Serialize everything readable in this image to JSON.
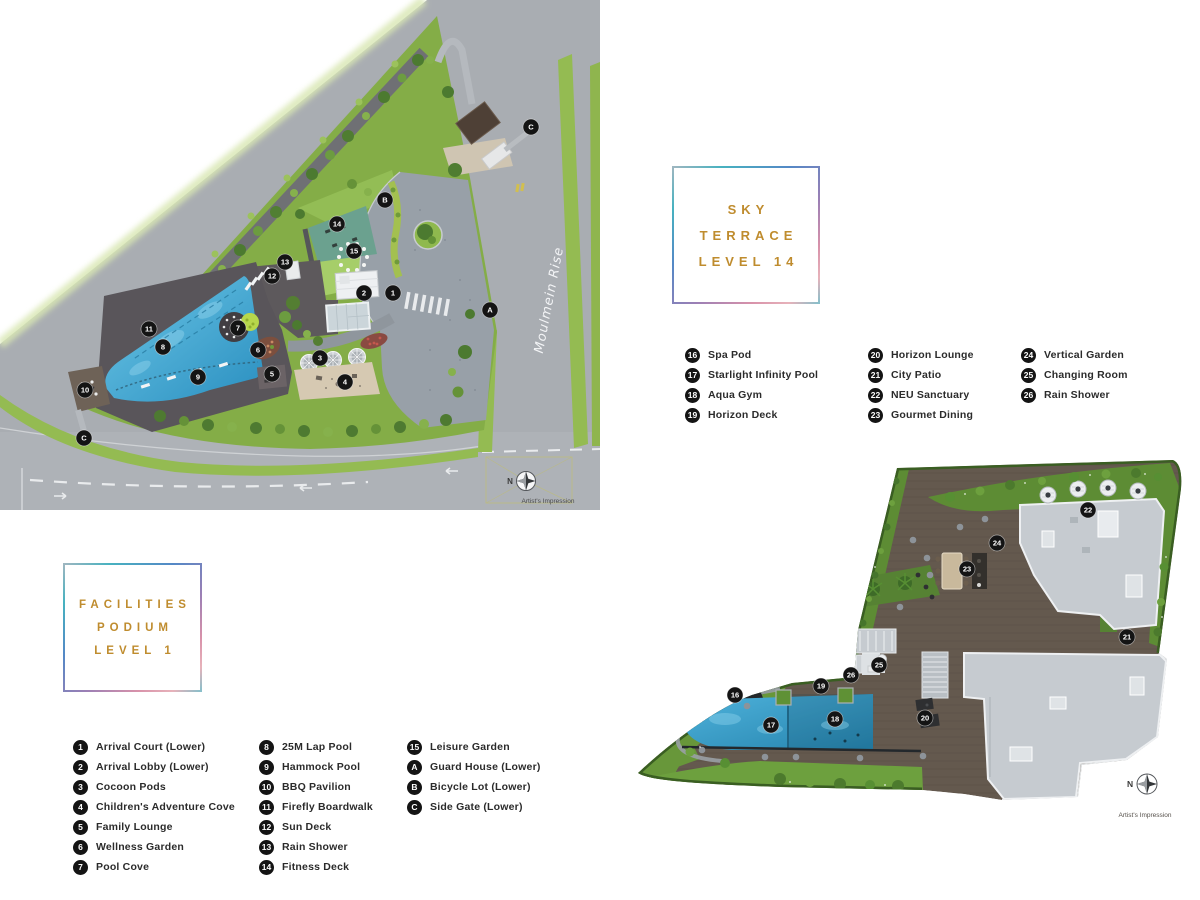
{
  "colors": {
    "accent_gold": "#bf8c2e",
    "legend_badge": "#141414",
    "legend_text": "#2b2b2b",
    "pool_blue": "#2f95c4",
    "grass_green": "#94bb52",
    "road_gray": "#a9adb2",
    "deck_wood": "#64594e",
    "roof_gray": "#c6cbd0"
  },
  "plans": {
    "podium": {
      "title_lines": [
        "FACILITIES",
        "PODIUM",
        "LEVEL 1"
      ],
      "road_label": "Moulmein Rise",
      "compass_label": "N",
      "artist_note": "Artist's Impression",
      "legend": {
        "columns": [
          [
            {
              "num": "1",
              "label": "Arrival Court (Lower)"
            },
            {
              "num": "2",
              "label": "Arrival Lobby (Lower)"
            },
            {
              "num": "3",
              "label": "Cocoon Pods"
            },
            {
              "num": "4",
              "label": "Children's Adventure Cove"
            },
            {
              "num": "5",
              "label": "Family Lounge"
            },
            {
              "num": "6",
              "label": "Wellness Garden"
            },
            {
              "num": "7",
              "label": "Pool Cove"
            }
          ],
          [
            {
              "num": "8",
              "label": "25M Lap Pool"
            },
            {
              "num": "9",
              "label": "Hammock Pool"
            },
            {
              "num": "10",
              "label": "BBQ Pavilion"
            },
            {
              "num": "11",
              "label": "Firefly Boardwalk"
            },
            {
              "num": "12",
              "label": "Sun Deck"
            },
            {
              "num": "13",
              "label": "Rain Shower"
            },
            {
              "num": "14",
              "label": "Fitness Deck"
            }
          ],
          [
            {
              "num": "15",
              "label": "Leisure Garden"
            },
            {
              "num": "A",
              "label": "Guard House (Lower)"
            },
            {
              "num": "B",
              "label": "Bicycle Lot (Lower)"
            },
            {
              "num": "C",
              "label": "Side Gate (Lower)"
            }
          ]
        ]
      },
      "markers": [
        {
          "label": "C",
          "x": 531,
          "y": 127
        },
        {
          "label": "B",
          "x": 385,
          "y": 200
        },
        {
          "label": "14",
          "x": 337,
          "y": 224
        },
        {
          "label": "15",
          "x": 354,
          "y": 251
        },
        {
          "label": "13",
          "x": 285,
          "y": 262
        },
        {
          "label": "12",
          "x": 272,
          "y": 276
        },
        {
          "label": "2",
          "x": 364,
          "y": 293
        },
        {
          "label": "1",
          "x": 393,
          "y": 293
        },
        {
          "label": "A",
          "x": 490,
          "y": 310
        },
        {
          "label": "11",
          "x": 149,
          "y": 329
        },
        {
          "label": "7",
          "x": 238,
          "y": 328
        },
        {
          "label": "8",
          "x": 163,
          "y": 347
        },
        {
          "label": "6",
          "x": 258,
          "y": 350
        },
        {
          "label": "3",
          "x": 320,
          "y": 358
        },
        {
          "label": "9",
          "x": 198,
          "y": 377
        },
        {
          "label": "5",
          "x": 272,
          "y": 374
        },
        {
          "label": "4",
          "x": 345,
          "y": 382
        },
        {
          "label": "10",
          "x": 85,
          "y": 390
        },
        {
          "label": "C",
          "x": 84,
          "y": 438
        }
      ]
    },
    "sky": {
      "title_lines": [
        "SKY",
        "TERRACE",
        "LEVEL 14"
      ],
      "compass_label": "N",
      "artist_note": "Artist's Impression",
      "legend": {
        "columns": [
          [
            {
              "num": "16",
              "label": "Spa Pod"
            },
            {
              "num": "17",
              "label": "Starlight Infinity Pool"
            },
            {
              "num": "18",
              "label": "Aqua Gym"
            },
            {
              "num": "19",
              "label": "Horizon Deck"
            }
          ],
          [
            {
              "num": "20",
              "label": "Horizon Lounge"
            },
            {
              "num": "21",
              "label": "City Patio"
            },
            {
              "num": "22",
              "label": "NEU Sanctuary"
            },
            {
              "num": "23",
              "label": "Gourmet Dining"
            }
          ],
          [
            {
              "num": "24",
              "label": "Vertical Garden"
            },
            {
              "num": "25",
              "label": "Changing Room"
            },
            {
              "num": "26",
              "label": "Rain Shower"
            }
          ]
        ]
      },
      "markers": [
        {
          "label": "22",
          "x": 458,
          "y": 63
        },
        {
          "label": "24",
          "x": 367,
          "y": 96
        },
        {
          "label": "23",
          "x": 337,
          "y": 122
        },
        {
          "label": "21",
          "x": 497,
          "y": 190
        },
        {
          "label": "25",
          "x": 249,
          "y": 218
        },
        {
          "label": "26",
          "x": 221,
          "y": 228
        },
        {
          "label": "19",
          "x": 191,
          "y": 239
        },
        {
          "label": "16",
          "x": 105,
          "y": 248
        },
        {
          "label": "20",
          "x": 295,
          "y": 271
        },
        {
          "label": "18",
          "x": 205,
          "y": 272
        },
        {
          "label": "17",
          "x": 141,
          "y": 278
        }
      ]
    }
  }
}
